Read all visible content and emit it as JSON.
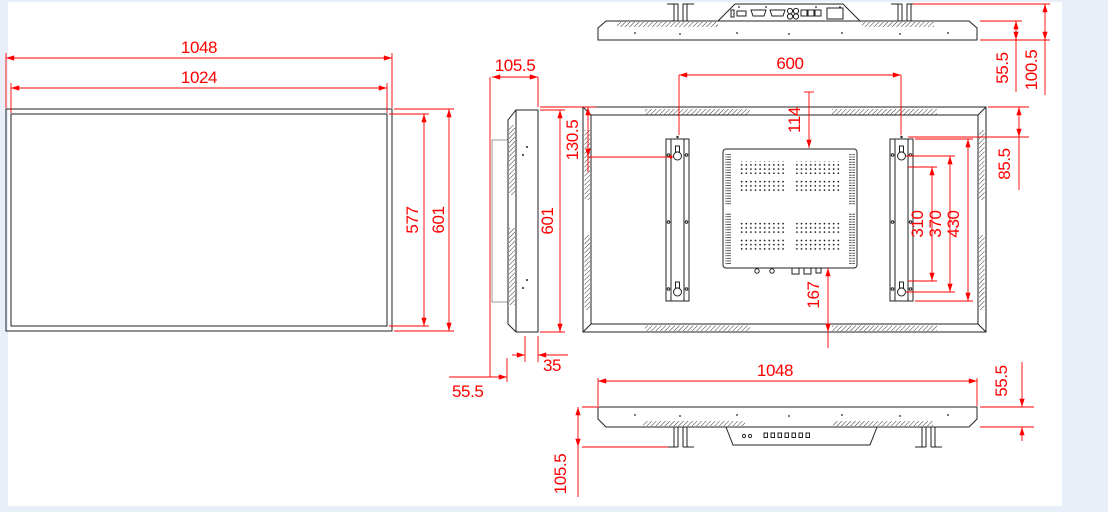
{
  "page": {
    "background_color": "#e9eff9",
    "paper_color": "#ffffff",
    "dimension_color": "#ff0000",
    "line_color": "#222222"
  },
  "views": {
    "front": {
      "dims": {
        "outer_width": "1048",
        "screen_width": "1024",
        "screen_height": "577",
        "outer_height": "601"
      }
    },
    "side": {
      "dims": {
        "depth_total": "105.5",
        "height": "601",
        "rear_depth": "35",
        "body_depth": "55.5"
      }
    },
    "rear": {
      "dims": {
        "mount_spacing": "600",
        "top_to_box": "114",
        "top_to_keyhole": "130.5",
        "top_to_bracket": "85.5",
        "slot_span": "310",
        "keyhole_span": "370",
        "bracket_length": "430",
        "box_to_bottom": "167"
      }
    },
    "top": {
      "dims": {
        "body_depth": "55.5",
        "total_depth": "100.5"
      }
    },
    "bottom": {
      "dims": {
        "width": "1048",
        "body_depth": "55.5",
        "depth_with_bracket": "105.5"
      }
    }
  }
}
